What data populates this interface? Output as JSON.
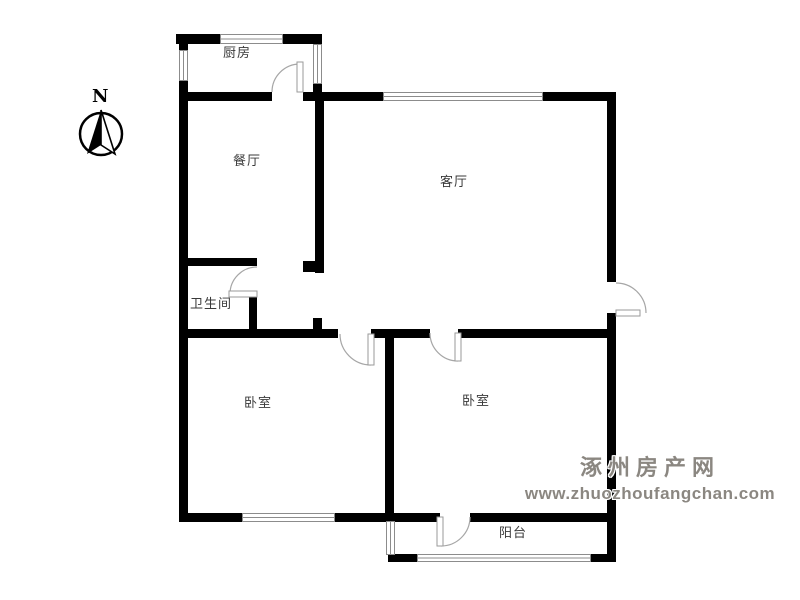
{
  "compass": {
    "north_label": "N"
  },
  "rooms": {
    "kitchen": {
      "label": "厨房"
    },
    "dining": {
      "label": "餐厅"
    },
    "living": {
      "label": "客厅"
    },
    "bathroom": {
      "label": "卫生间"
    },
    "bedroom_left": {
      "label": "卧室"
    },
    "bedroom_right": {
      "label": "卧室"
    },
    "balcony": {
      "label": "阳台"
    }
  },
  "watermark": {
    "site_name": "涿州房产网",
    "site_url": "www.zhuozhoufangchan.com"
  },
  "colors": {
    "wall": "#000000",
    "window_frame": "#8c8c8c",
    "door_arc": "#a6a6a6",
    "label_text": "#3a3a3a",
    "watermark_text": "#8b8781"
  }
}
